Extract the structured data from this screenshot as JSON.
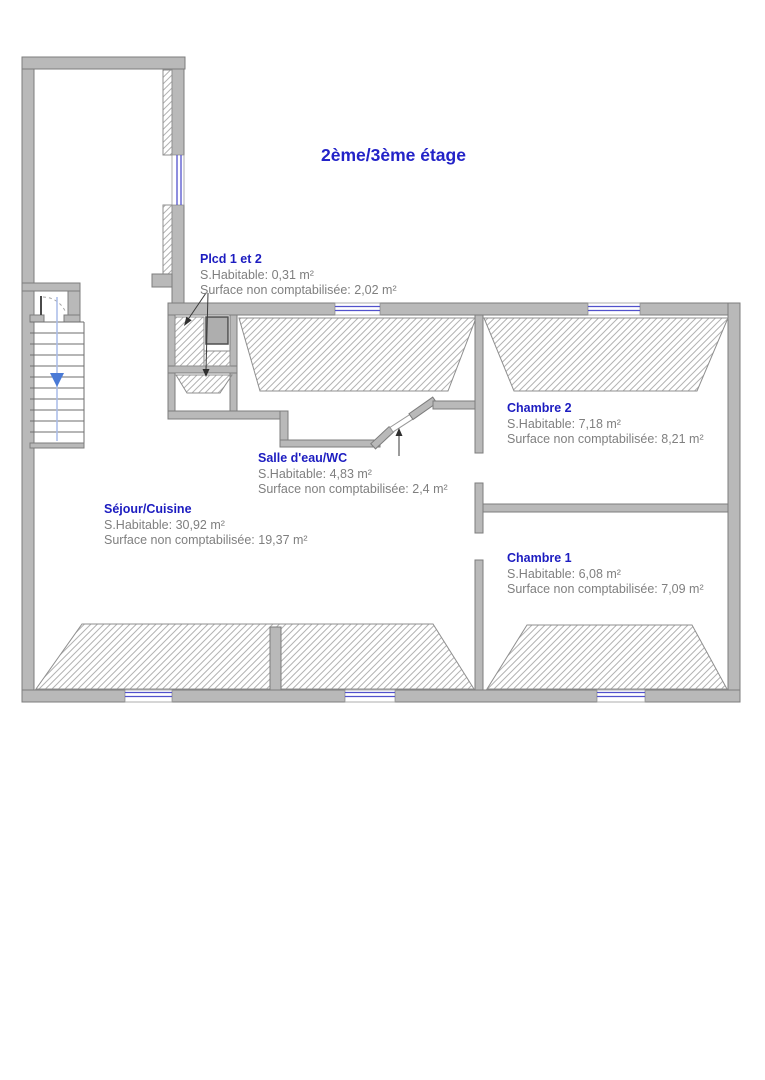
{
  "title": "2ème/3ème étage",
  "rooms": [
    {
      "name": "Plcd 1 et 2",
      "habitable": "S.Habitable: 0,31 m²",
      "non_comptabilisee": "Surface non comptabilisée: 2,02 m²"
    },
    {
      "name": "Salle d'eau/WC",
      "habitable": "S.Habitable: 4,83 m²",
      "non_comptabilisee": "Surface non comptabilisée: 2,4 m²"
    },
    {
      "name": "Séjour/Cuisine",
      "habitable": "S.Habitable: 30,92 m²",
      "non_comptabilisee": "Surface non comptabilisée: 19,37 m²"
    },
    {
      "name": "Chambre 2",
      "habitable": "S.Habitable: 7,18 m²",
      "non_comptabilisee": "Surface non comptabilisée: 8,21 m²"
    },
    {
      "name": "Chambre 1",
      "habitable": "S.Habitable: 6,08 m²",
      "non_comptabilisee": "Surface non comptabilisée: 7,09 m²"
    }
  ],
  "colors": {
    "title_blue": "#2323c8",
    "room_name_blue": "#1c1cc0",
    "body_text_gray": "#7f7f7f",
    "wall_fill": "#b9b9b9",
    "wall_stroke": "#7d7d7d",
    "hatch_line": "#b3b3b3",
    "window_glass_blue": "#5252cc",
    "stair_arrow_blue": "#4a7ad6"
  }
}
